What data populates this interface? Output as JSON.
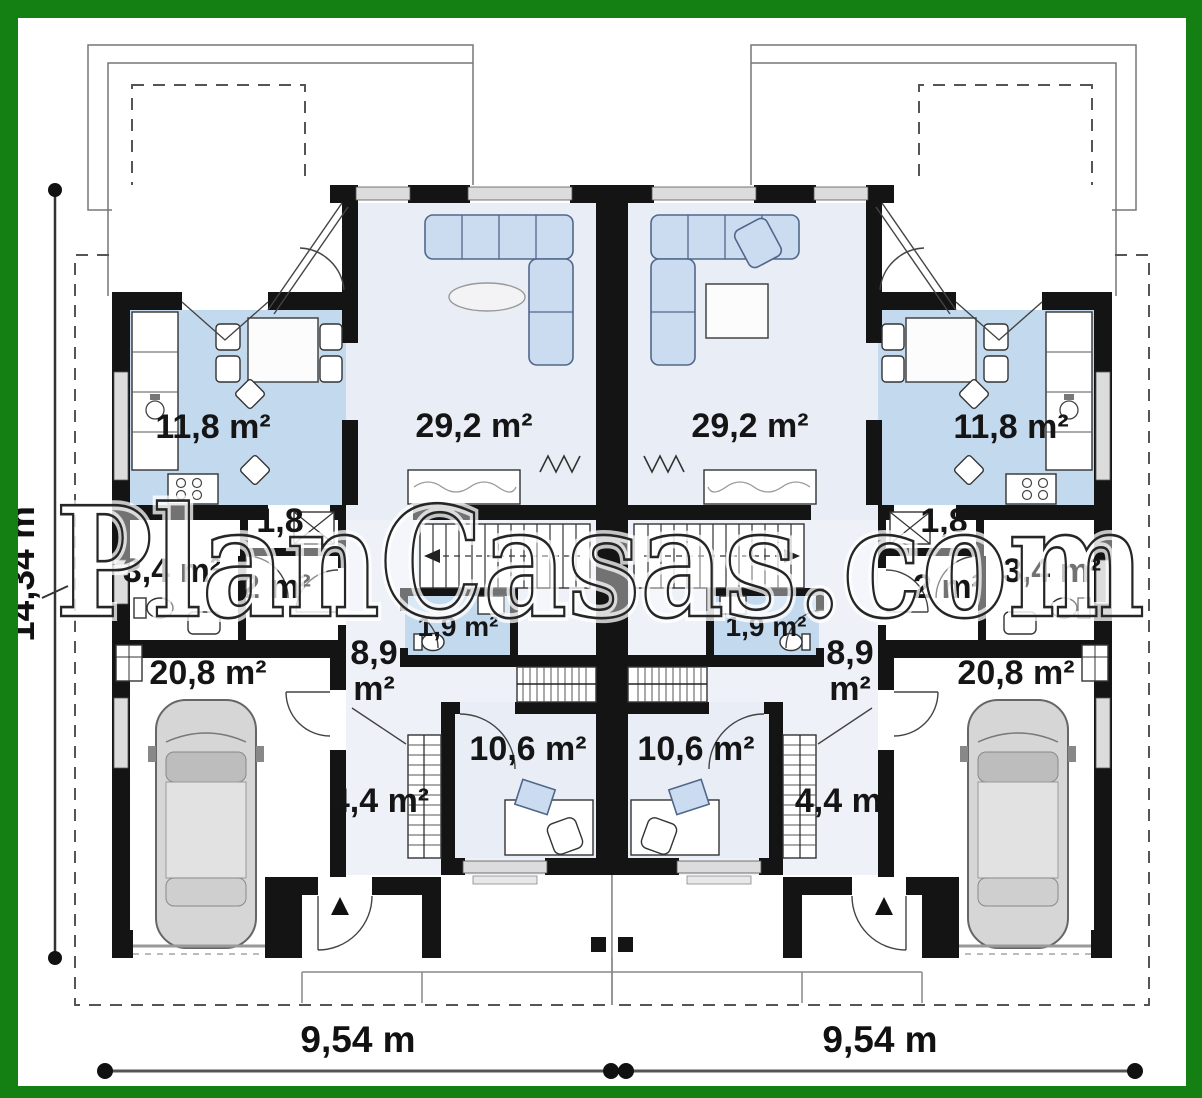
{
  "title": "Duplex ground floor plan",
  "watermark": "PlanCasas.com",
  "dimensions": {
    "total_depth": "14,34 m",
    "left_unit_width": "9,54 m",
    "right_unit_width": "9,54 m"
  },
  "units": {
    "left": {
      "kitchen": "11,8 m²",
      "living": "29,2 m²",
      "closet": "1,8",
      "wc": "3,4 m²",
      "hall": "2 m²",
      "bath": "1,9 m²",
      "corridor_line1": "8,9",
      "corridor_line2": "m²",
      "garage": "20,8 m²",
      "room": "10,6 m²",
      "storage": "4,4 m²"
    },
    "right": {
      "kitchen": "11,8 m²",
      "living": "29,2 m²",
      "closet": "1,8",
      "wc": "3,4 m²",
      "hall": "2 m²",
      "bath": "1,9 m²",
      "corridor_line1": "8,9",
      "corridor_line2": "m²",
      "garage": "20,8 m²",
      "room": "10,6 m²",
      "storage": "4,4 m²"
    }
  },
  "colors": {
    "green_frame": "#148014",
    "wall": "#141414",
    "floor_light": "#e8edf6",
    "floor_medium": "#c3d9ee",
    "floor_pale": "#eef1f8",
    "furniture_fill": "#ccdcf0",
    "furniture_stroke": "#51678a",
    "car_body": "#d6d6d6"
  }
}
